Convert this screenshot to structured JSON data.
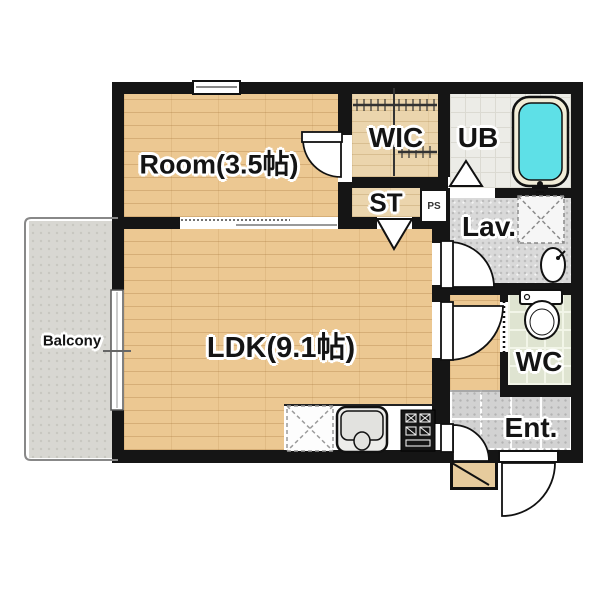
{
  "title": "1LDK apartment floor plan",
  "labels": {
    "room": "Room(3.5帖)",
    "wic": "WIC",
    "ub": "UB",
    "st": "ST",
    "ps": "PS",
    "lav": "Lav.",
    "ldk": "LDK(9.1帖)",
    "wc": "WC",
    "ent": "Ent.",
    "balcony": "Balcony"
  },
  "rooms": [
    {
      "name": "Room",
      "size_note": "3.5帖"
    },
    {
      "name": "LDK",
      "size_note": "9.1帖"
    },
    {
      "name": "WIC"
    },
    {
      "name": "UB"
    },
    {
      "name": "ST"
    },
    {
      "name": "PS"
    },
    {
      "name": "Lav."
    },
    {
      "name": "WC"
    },
    {
      "name": "Ent."
    },
    {
      "name": "Balcony"
    }
  ],
  "fixtures": [
    "bathtub-icon",
    "toilet-icon",
    "washbasin-icon",
    "washing-machine-space-icon",
    "refrigerator-space-icon",
    "kitchen-sink-icon",
    "stove-icon",
    "closet-rod-icon",
    "door-swing-icon",
    "folding-door-icon",
    "sliding-door-icon",
    "window-icon",
    "entrance-step-icon"
  ],
  "colors": {
    "wall": "#151515",
    "wood_floor": "#ecc892",
    "closet_wood": "#ebd5ad",
    "bathtub_water": "#5ee0e7",
    "balcony_floor": "#d8d7d2",
    "wc_tile": "#dfe4d1",
    "entrance_tile": "#d2d2d2",
    "lav_floor": "#d9d9d9",
    "label_text": "#141414",
    "label_halo": "#ffffff"
  }
}
